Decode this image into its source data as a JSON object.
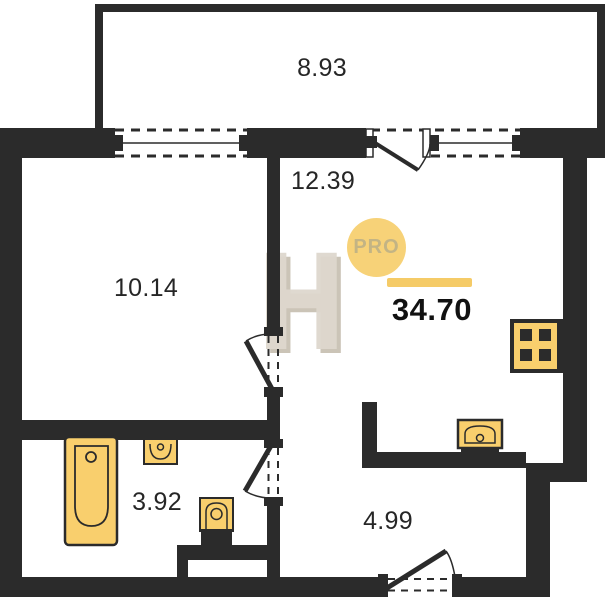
{
  "plan": {
    "badge": {
      "label": "PRO"
    },
    "total_area": {
      "value": "34.70"
    },
    "watermark": {
      "letter": "H"
    },
    "rooms": [
      {
        "name": "balcony",
        "area": "8.93"
      },
      {
        "name": "living-room",
        "area": "12.39"
      },
      {
        "name": "room",
        "area": "10.14"
      },
      {
        "name": "bathroom",
        "area": "3.92"
      },
      {
        "name": "hallway",
        "area": "4.99"
      }
    ],
    "fixtures": [
      "bathtub",
      "bathroom-sink",
      "toilet",
      "kitchen-sink",
      "stove"
    ],
    "colors": {
      "wall": "#2b2b2b",
      "fixture_fill": "#f9cf6d",
      "fixture_stroke": "#2b2b2b",
      "badge_bg": "#f7d278",
      "accent_bar": "#f5cb67",
      "watermark": "#d8d1c6"
    }
  }
}
